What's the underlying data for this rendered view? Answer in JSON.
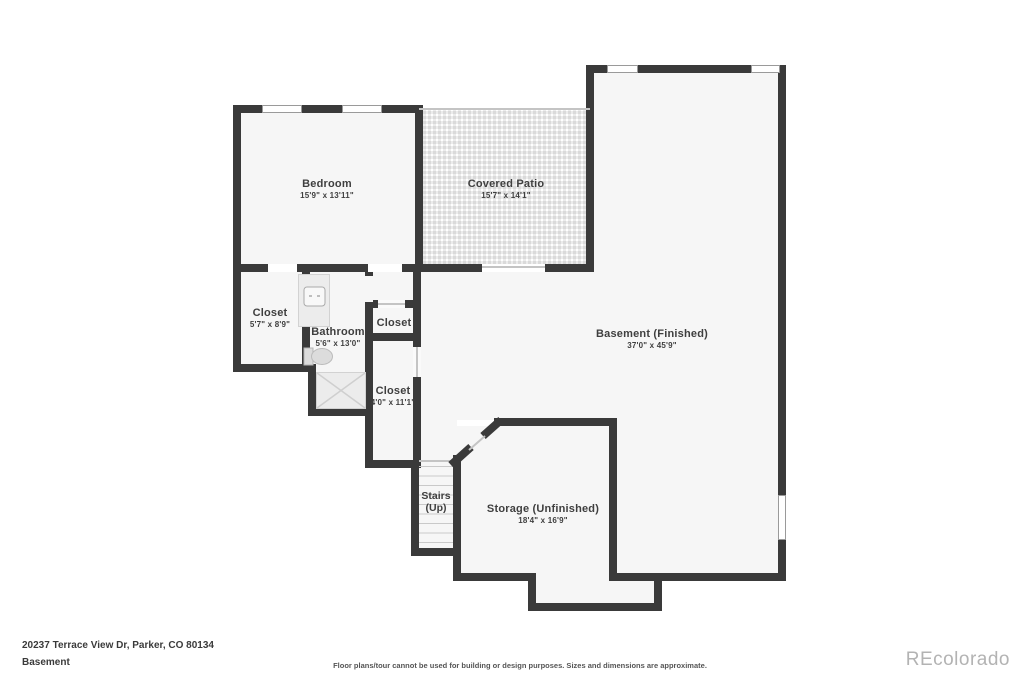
{
  "floorplan": {
    "rooms": {
      "bedroom": {
        "name": "Bedroom",
        "dims": "15'9\" x 13'11\""
      },
      "covered_patio": {
        "name": "Covered Patio",
        "dims": "15'7\" x 14'1\""
      },
      "basement": {
        "name": "Basement (Finished)",
        "dims": "37'0\" x 45'9\""
      },
      "closet_left": {
        "name": "Closet",
        "dims": "5'7\" x 8'9\""
      },
      "bathroom": {
        "name": "Bathroom",
        "dims": "5'6\" x 13'0\""
      },
      "closet_small": {
        "name": "Closet"
      },
      "closet_tall": {
        "name": "Closet",
        "dims": "4'0\" x 11'1\""
      },
      "stairs": {
        "name": "Stairs",
        "direction": "(Up)"
      },
      "storage": {
        "name": "Storage (Unfinished)",
        "dims": "18'4\" x 16'9\""
      }
    }
  },
  "footer": {
    "address": "20237 Terrace View Dr, Parker, CO 80134",
    "level": "Basement",
    "disclaimer": "Floor plans/tour cannot be used for building or design purposes. Sizes and dimensions are approximate.",
    "watermark": "REcolorado"
  },
  "colors": {
    "wall": "#3a3a3a",
    "room_fill": "#f6f6f6",
    "label": "#3f3f3f",
    "watermark": "#b3b3b3",
    "window_border": "#9a9a9a"
  }
}
